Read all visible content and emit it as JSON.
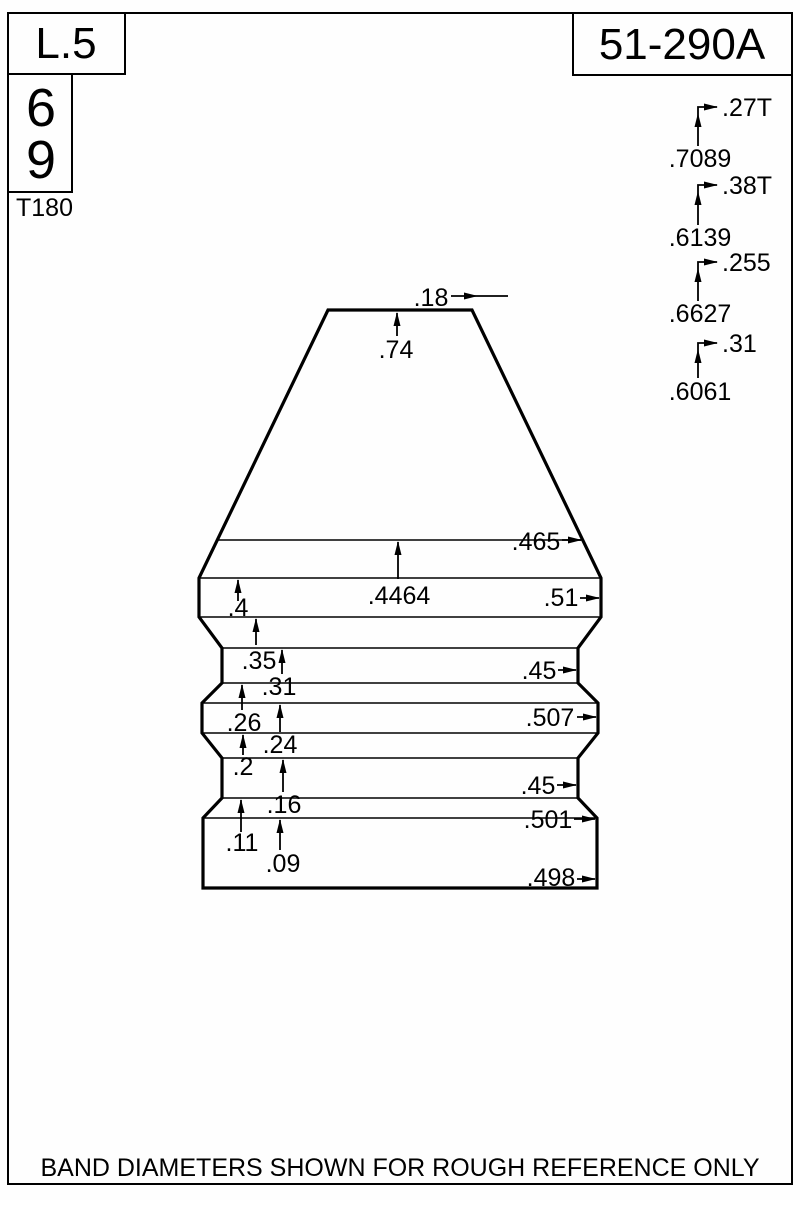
{
  "page": {
    "scale_label": "L.5",
    "mold_number": "51-290A",
    "cavity_upper": "6",
    "cavity_lower": "9",
    "tool_id": "T180",
    "footer_note": "BAND DIAMETERS SHOWN FOR ROUGH REFERENCE ONLY"
  },
  "nose_stack": [
    {
      "offset_label": ".27T",
      "length_label": ".7089"
    },
    {
      "offset_label": ".38T",
      "length_label": ".6139"
    },
    {
      "offset_label": ".255",
      "length_label": ".6627"
    },
    {
      "offset_label": ".31",
      "length_label": ".6061"
    }
  ],
  "bullet_dims": {
    "meplat_diameter": ".18",
    "lengths": [
      {
        "label": ".74"
      },
      {
        "label": ".4464"
      },
      {
        "label": ".4"
      },
      {
        "label": ".35"
      },
      {
        "label": ".31"
      },
      {
        "label": ".26"
      },
      {
        "label": ".24"
      },
      {
        "label": ".2"
      },
      {
        "label": ".16"
      },
      {
        "label": ".11"
      },
      {
        "label": ".09"
      }
    ],
    "diameters": [
      {
        "label": ".465"
      },
      {
        "label": ".51"
      },
      {
        "label": ".45"
      },
      {
        "label": ".507"
      },
      {
        "label": ".45"
      },
      {
        "label": ".501"
      },
      {
        "label": ".498"
      }
    ]
  }
}
